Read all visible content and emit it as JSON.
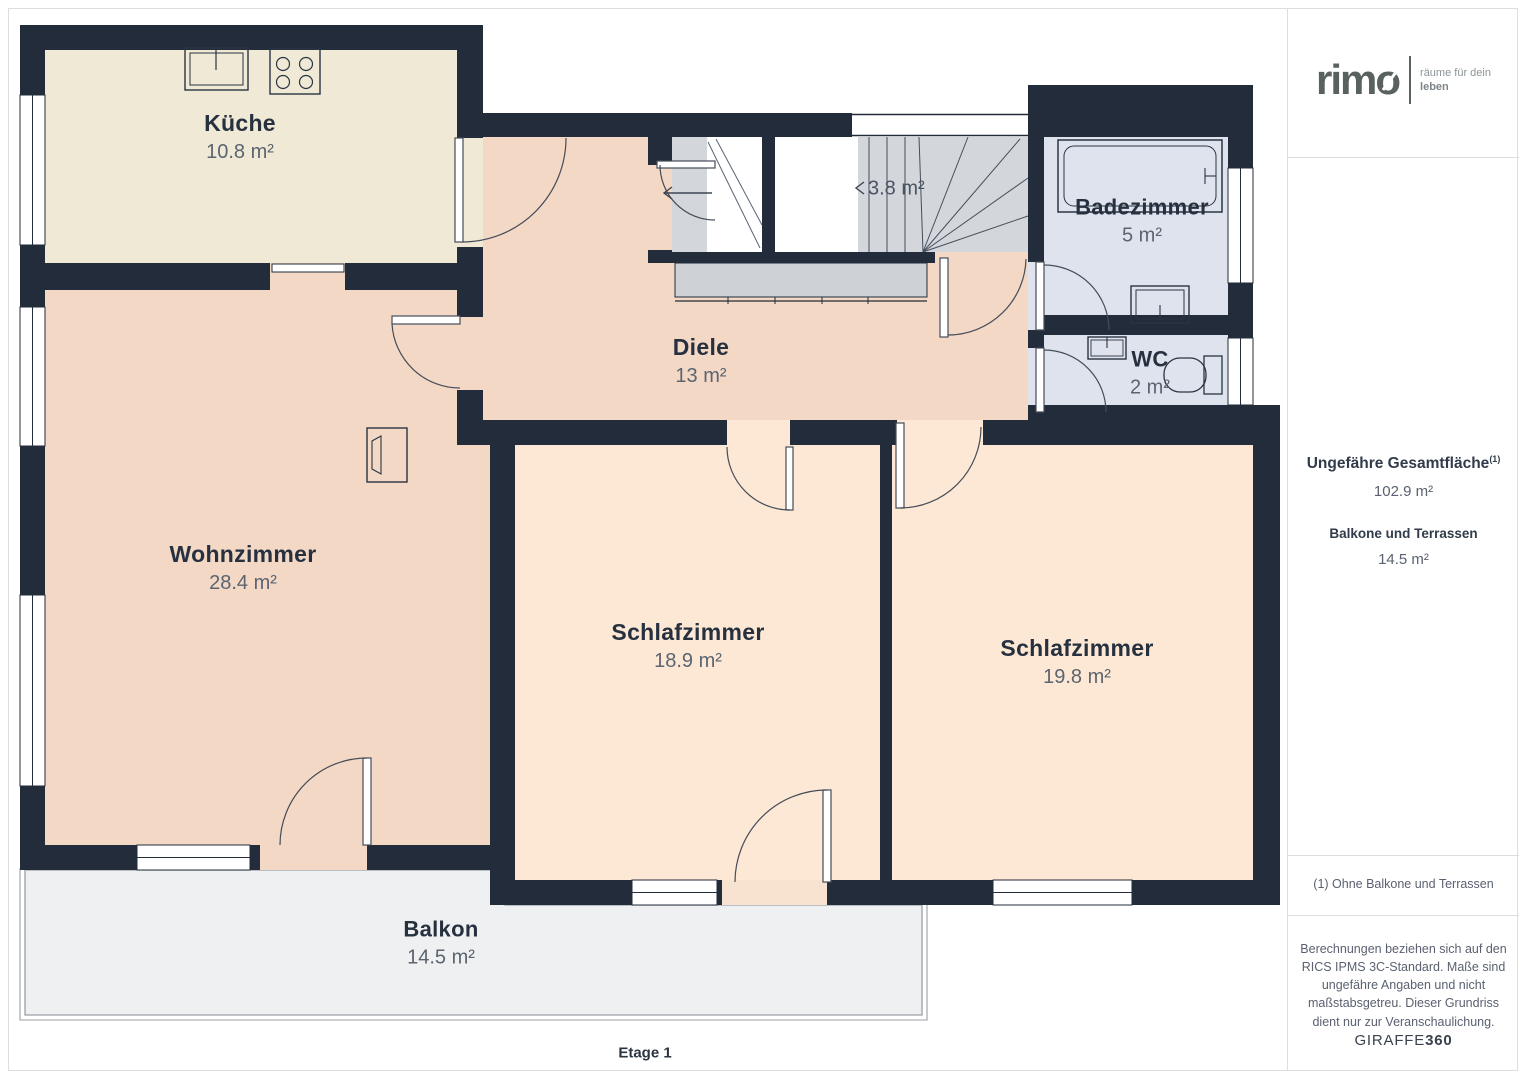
{
  "page": {
    "floor_label": "Etage 1"
  },
  "plan": {
    "rooms": [
      {
        "id": "kueche",
        "name": "Küche",
        "area": "10.8 m²"
      },
      {
        "id": "wohnzimmer",
        "name": "Wohnzimmer",
        "area": "28.4 m²"
      },
      {
        "id": "diele",
        "name": "Diele",
        "area": "13 m²"
      },
      {
        "id": "schlafzimmer-1",
        "name": "Schlafzimmer",
        "area": "18.9 m²"
      },
      {
        "id": "schlafzimmer-2",
        "name": "Schlafzimmer",
        "area": "19.8 m²"
      },
      {
        "id": "badezimmer",
        "name": "Badezimmer",
        "area": "5 m²"
      },
      {
        "id": "wc",
        "name": "WC",
        "area": "2 m²"
      },
      {
        "id": "balkon",
        "name": "Balkon",
        "area": "14.5 m²"
      }
    ],
    "staircase_area": "3.8 m²"
  },
  "sidebar": {
    "logo": {
      "brand": "rimo",
      "tagline_line1": "räume für dein",
      "tagline_line2": "leben"
    },
    "summary": {
      "total_label": "Ungefähre Gesamtfläche",
      "total_footnote_marker": "(1)",
      "total_value": "102.9 m²",
      "balcony_label": "Balkone und Terrassen",
      "balcony_value": "14.5 m²"
    },
    "footnote": "(1) Ohne Balkone und Terrassen",
    "disclaimer": "Berechnungen beziehen sich auf den RICS IPMS 3C-Standard. Maße sind ungefähre Angaben und nicht maßstabsgetreu. Dieser Grundriss dient nur zur Veranschaulichung.",
    "credit_brand": "GIRAFFE",
    "credit_suffix": "360"
  },
  "colors": {
    "wall": "#222c3a",
    "kitchen_floor": "#efe9d6",
    "living_floor": "#f3d8c6",
    "bedroom_floor": "#fce8d5",
    "bath_floor": "#dfe3ee",
    "stair_gray": "#d3d6da",
    "balcony_fill": "#eef0f1",
    "frame_line": "#dcdee1",
    "label_dark": "#26303f",
    "label_gray": "#5c6470",
    "logo_color": "#59625f"
  }
}
